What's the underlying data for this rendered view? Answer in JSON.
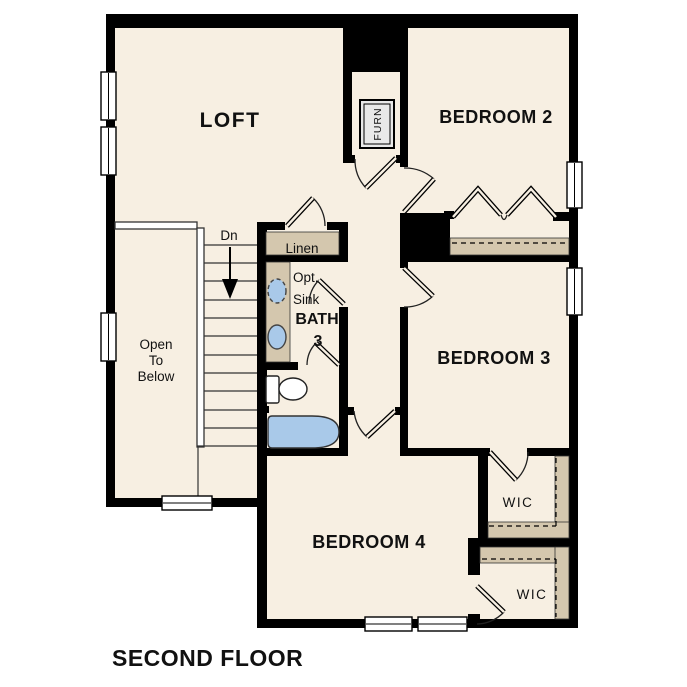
{
  "title": "SECOND FLOOR",
  "rooms": {
    "loft": "LOFT",
    "bedroom2": "BEDROOM 2",
    "bedroom3": "BEDROOM 3",
    "bedroom4": "BEDROOM 4",
    "bath_line1": "BATH",
    "bath_line2": "3",
    "linen": "Linen",
    "opt_sink_line1": "Opt.",
    "opt_sink_line2": "Sink",
    "wic_top": "WIC",
    "wic_bottom": "WIC",
    "open_below_line1": "Open",
    "open_below_line2": "To",
    "open_below_line3": "Below",
    "stairs_direction": "Dn",
    "furnace": "FURN"
  },
  "colors": {
    "floor": "#f7efe2",
    "wall": "#000000",
    "shelf": "#d4c7ae",
    "fixture": "#a9c9e9",
    "appliance": "#e9e9e9",
    "paper": "#ffffff"
  }
}
